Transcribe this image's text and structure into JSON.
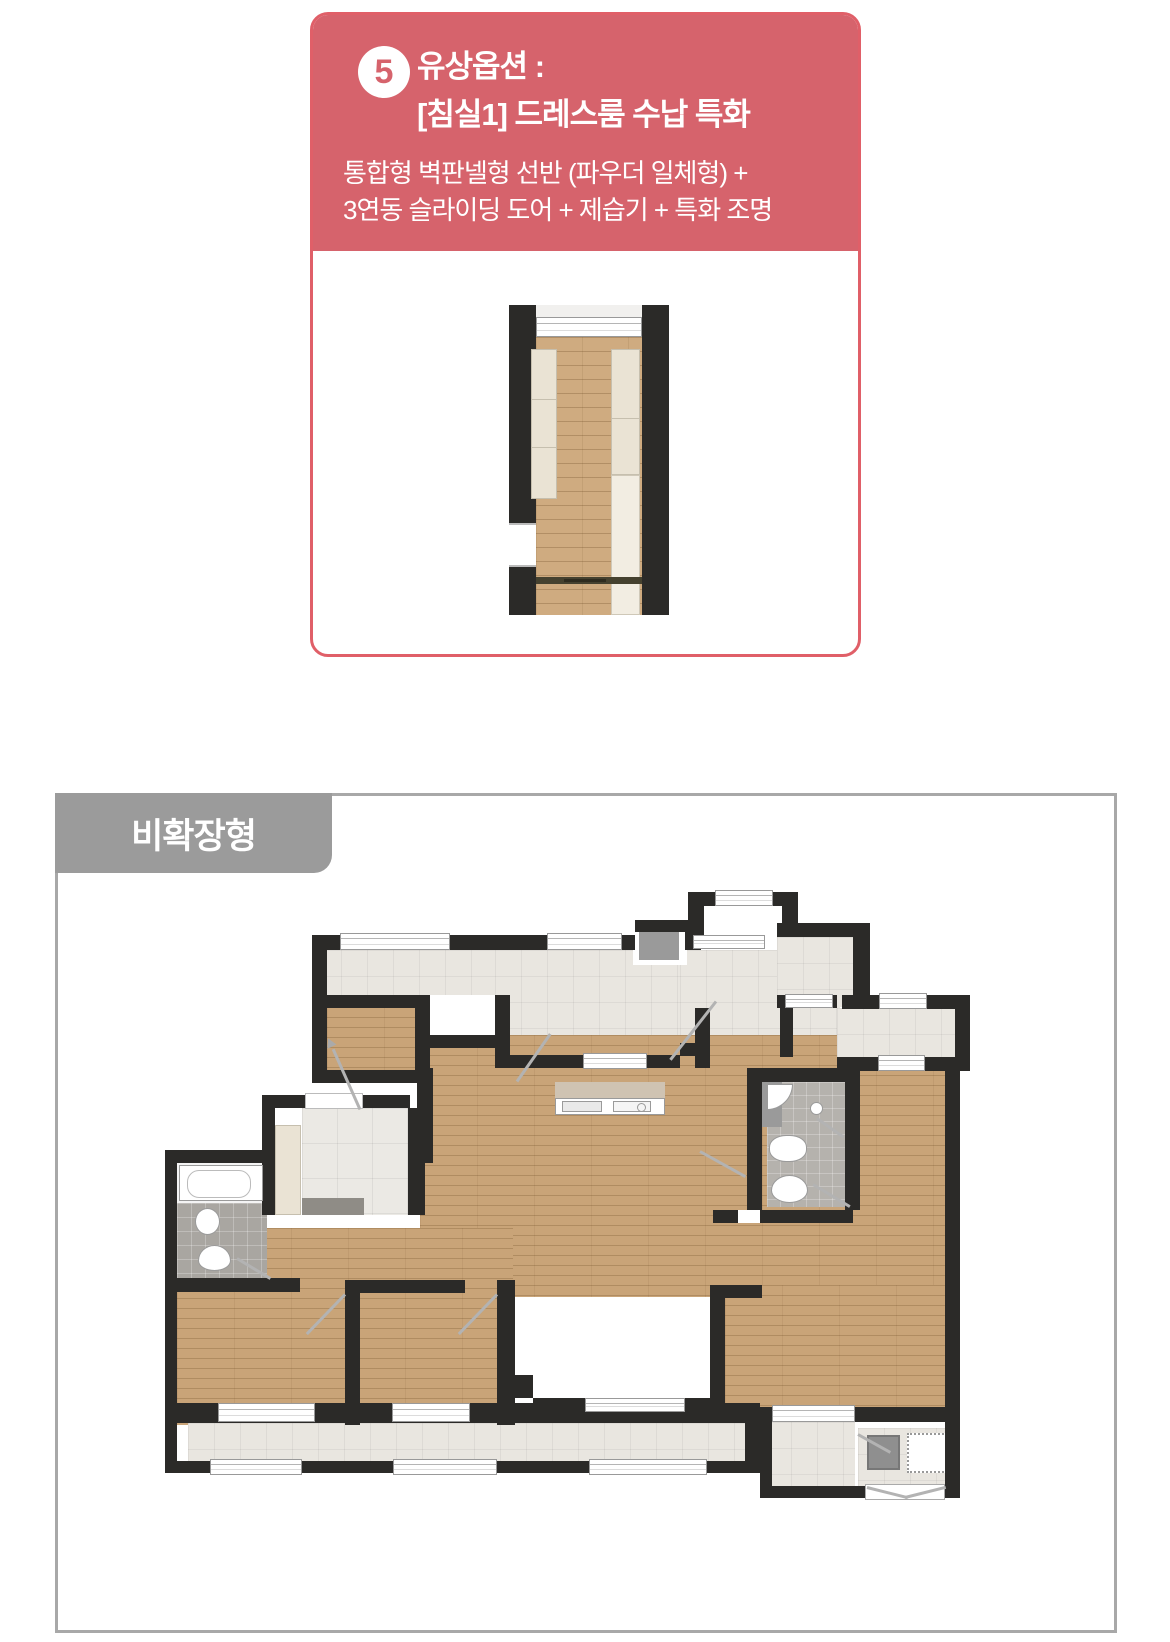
{
  "option_card": {
    "badge_number": "5",
    "title_line1": "유상옵션 :",
    "title_line2": "[침실1] 드레스룸 수납 특화",
    "description_line1": "통합형 벽판넬형 선반 (파우더 일체형) +",
    "description_line2": "3연동 슬라이딩 도어 + 제습기 + 특화 조명"
  },
  "floor_plan_section": {
    "label": "비확장형"
  },
  "colors": {
    "card_red": "#d6636c",
    "card_border": "#e05f68",
    "tab_gray": "#9b9b9b",
    "box_border": "#a8a8a8",
    "wall_dark": "#2b2a28",
    "wood_floor": "#c9a478",
    "tile_light": "#e9e6e0",
    "bath_tile_gray": "#a9a6a1",
    "cabinet_cream": "#eae3d4",
    "fixture_white": "#ffffff"
  }
}
